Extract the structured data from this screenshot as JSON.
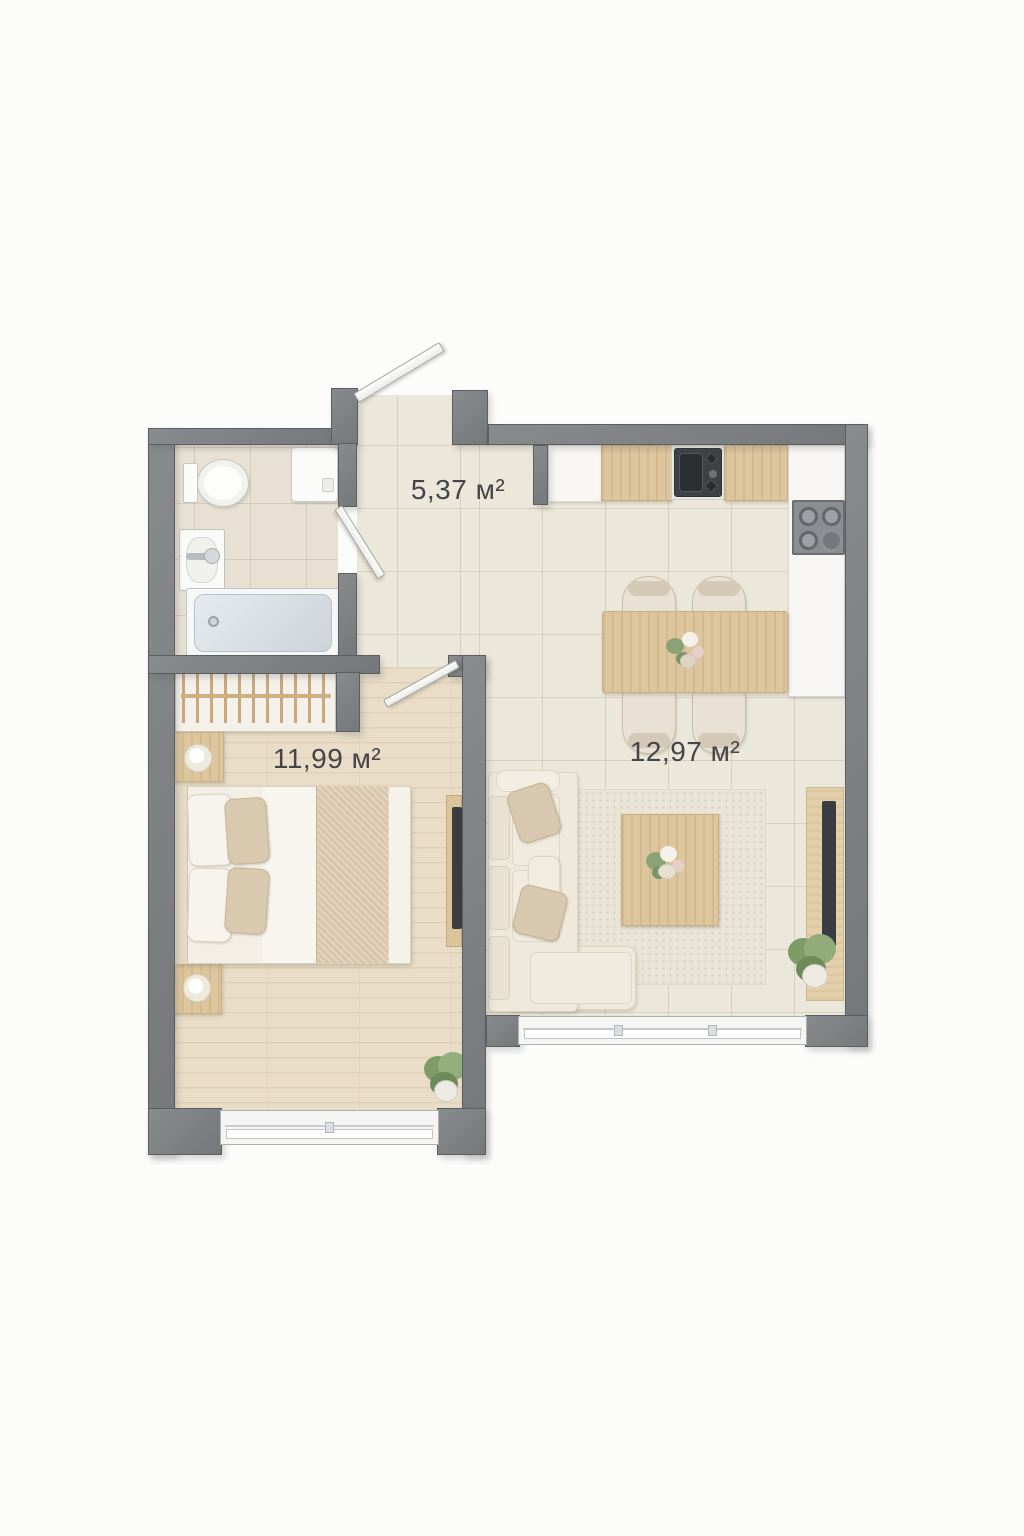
{
  "plan": {
    "type": "apartment-floor-plan-top-view",
    "rooms": {
      "hallway": {
        "area_label": "5,37 м²"
      },
      "bedroom": {
        "area_label": "11,99 м²"
      },
      "living_kitchen": {
        "area_label": "12,97 м²"
      }
    },
    "colors": {
      "wall": "#75787b",
      "wall_edge": "#5c5f62",
      "tile_floor": "#ece7db",
      "bath_tile": "#e7e0d3",
      "wood_floor": "#e9ddc7",
      "counter_wood": "#ddc69e",
      "fabric": "#efe9dc",
      "appliance_dark": "#3a3d40",
      "plant_green": "#7f9c6a",
      "label_text": "#454548"
    }
  }
}
